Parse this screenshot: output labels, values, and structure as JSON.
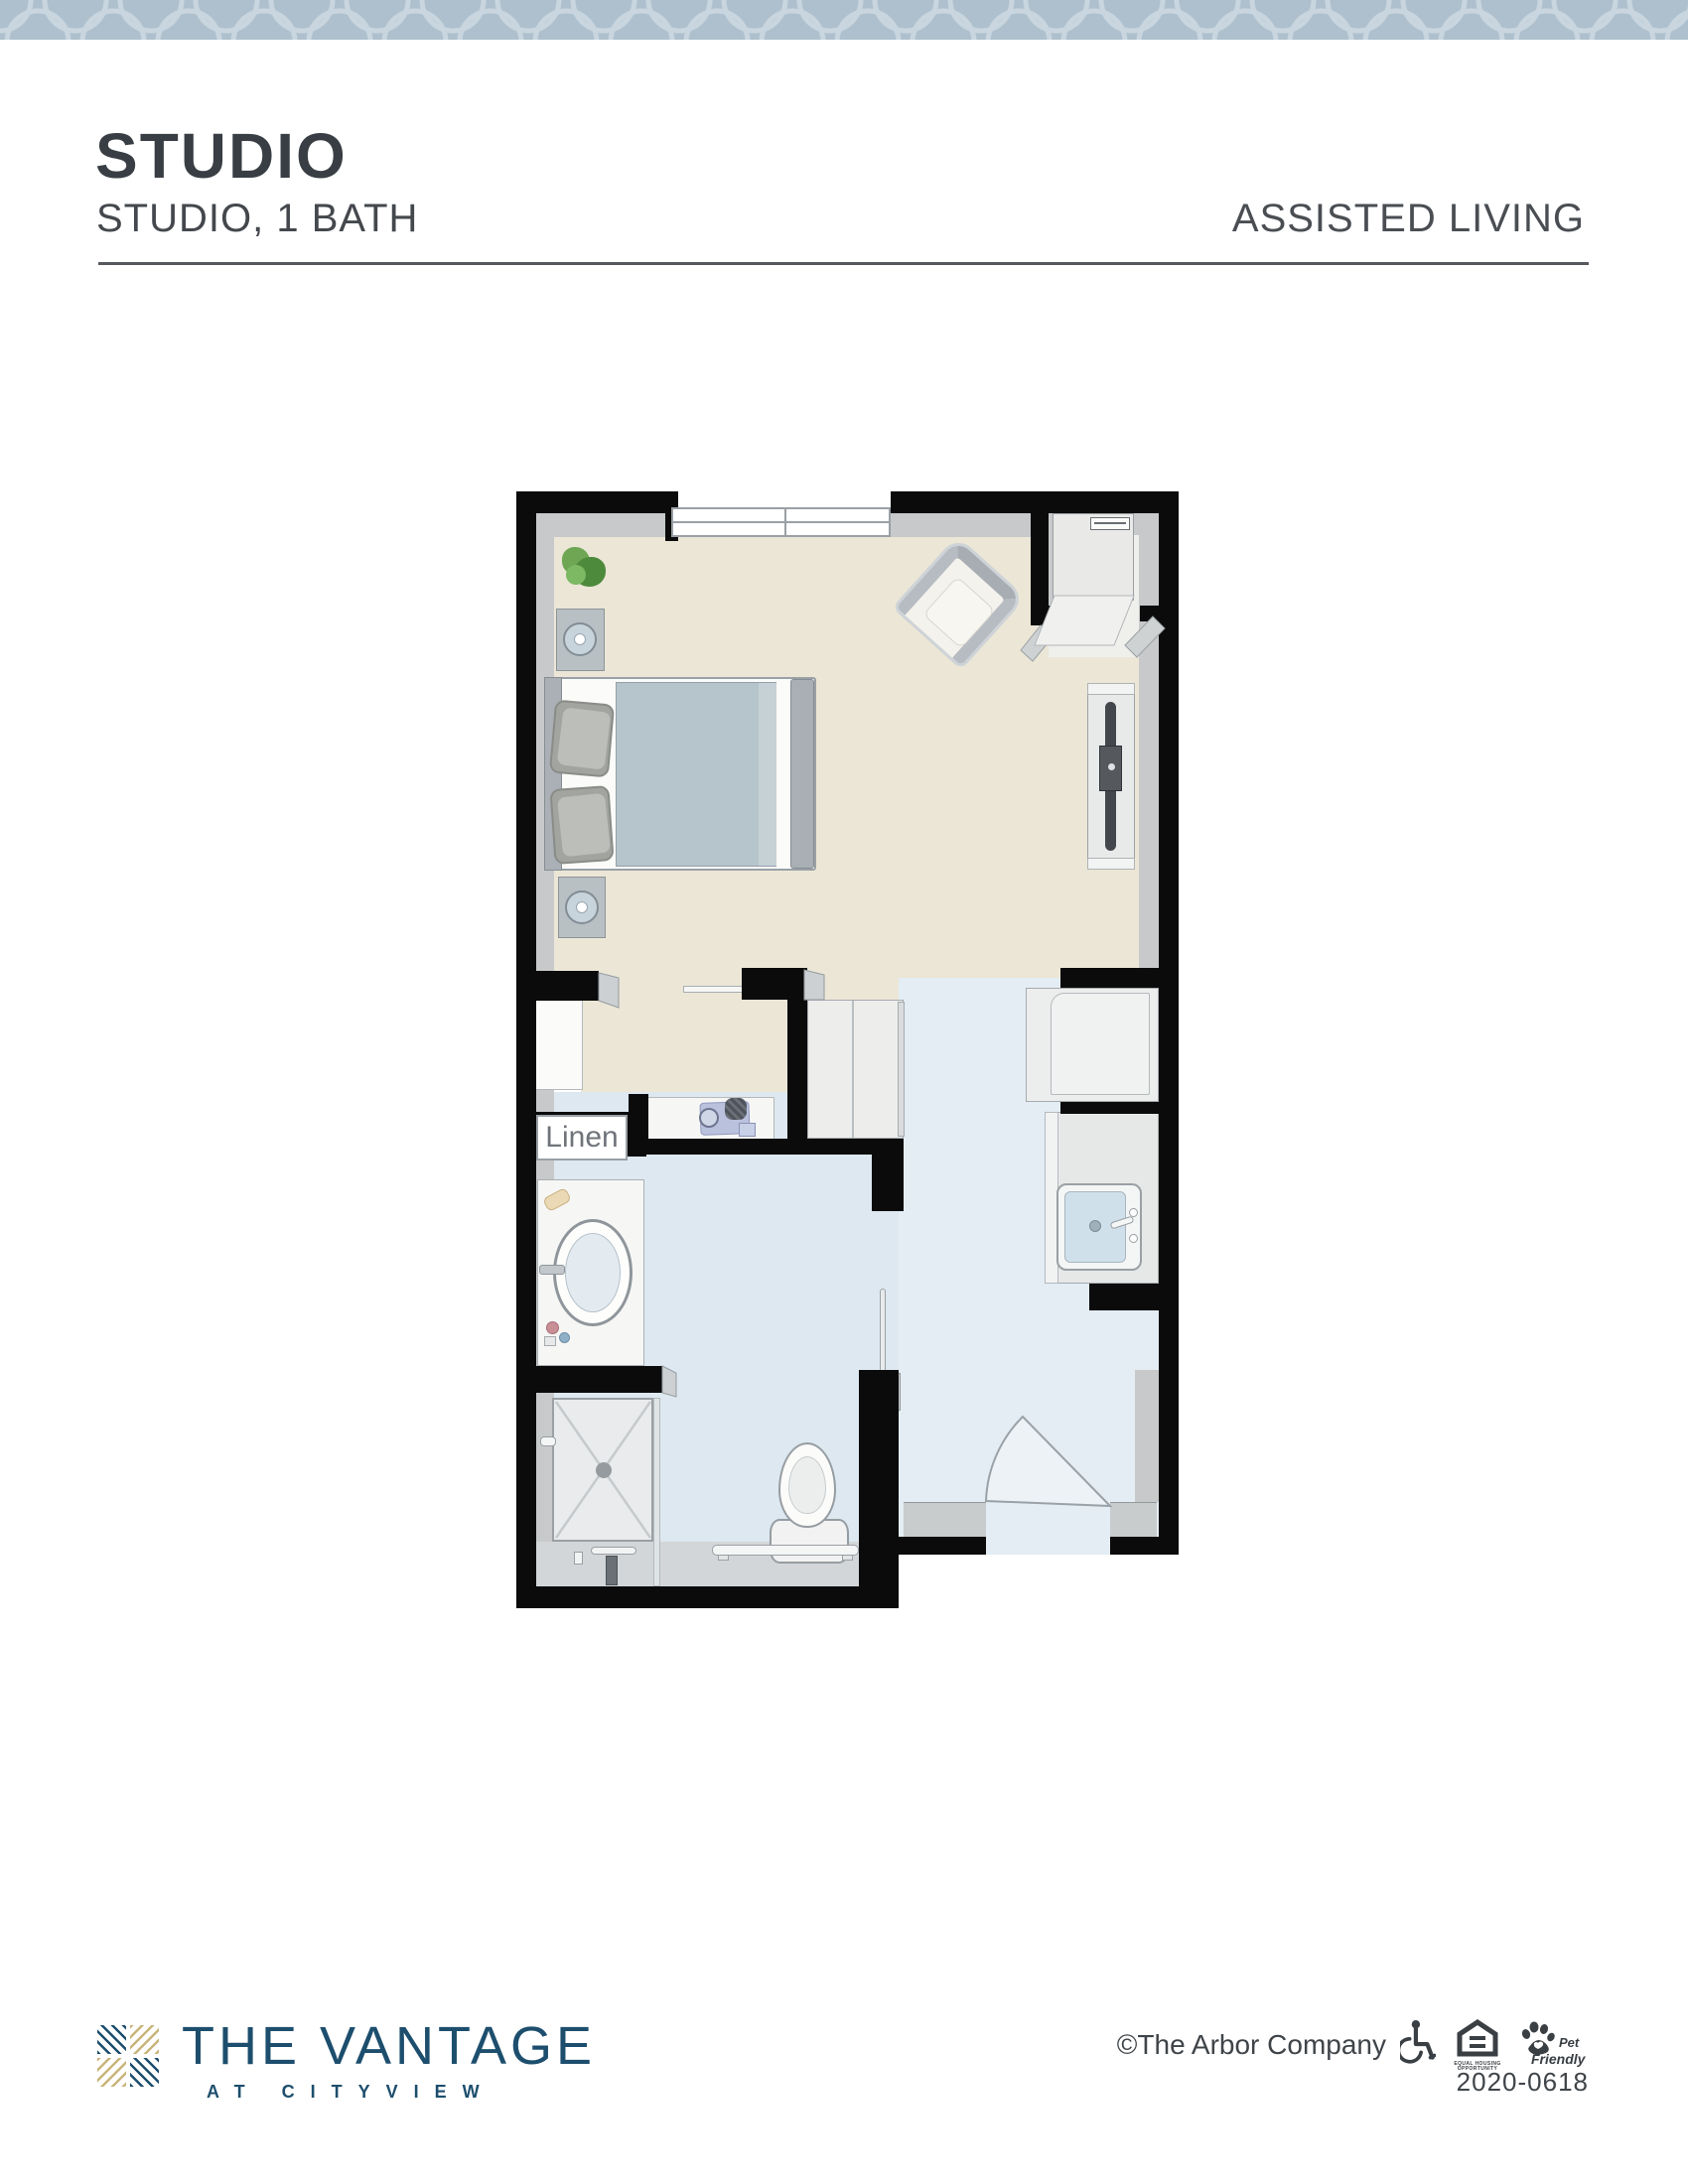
{
  "banner": {
    "pattern": "quatrefoil-lattice",
    "color": "#aec0cd",
    "line_color": "#c9d6df"
  },
  "header": {
    "title": "STUDIO",
    "subtitle": "STUDIO, 1 BATH",
    "community_type": "ASSISTED LIVING"
  },
  "floor_plan": {
    "kind": "studio-apartment-floor-plan",
    "labels": {
      "linen": "Linen"
    },
    "rooms": [
      "living-sleeping-area",
      "bathroom",
      "entry-hall",
      "linen-closet",
      "wardrobe-closet",
      "utility-niche"
    ],
    "fixtures": [
      "window",
      "plant",
      "nightstand-with-lamp",
      "bed",
      "armchair",
      "tv-console",
      "wardrobe",
      "appliance",
      "kitchenette-sink",
      "amenity-counter",
      "vanity-sink",
      "walk-in-shower",
      "toilet",
      "grab-bars",
      "entry-door",
      "sliding-door"
    ],
    "colors": {
      "wall": "#0b0b0b",
      "living_floor": "#ebe6d6",
      "bath_floor": "#dde8f0",
      "hall_floor": "#e3edf3",
      "fixture_gray": "#e9eaea",
      "mattress": "#b6c4cb"
    }
  },
  "footer": {
    "logo_main": "THE VANTAGE",
    "logo_sub": "AT CITYVIEW",
    "copyright": "©The Arbor Company",
    "equal_housing_label": "EQUAL HOUSING OPPORTUNITY",
    "pet_friendly_top": "Pet",
    "pet_friendly_bottom": "Friendly",
    "plan_number": "2020-0618",
    "colors": {
      "navy": "#1d4e6d",
      "tan": "#c9b57b",
      "icon_dark": "#3a3f44"
    }
  }
}
